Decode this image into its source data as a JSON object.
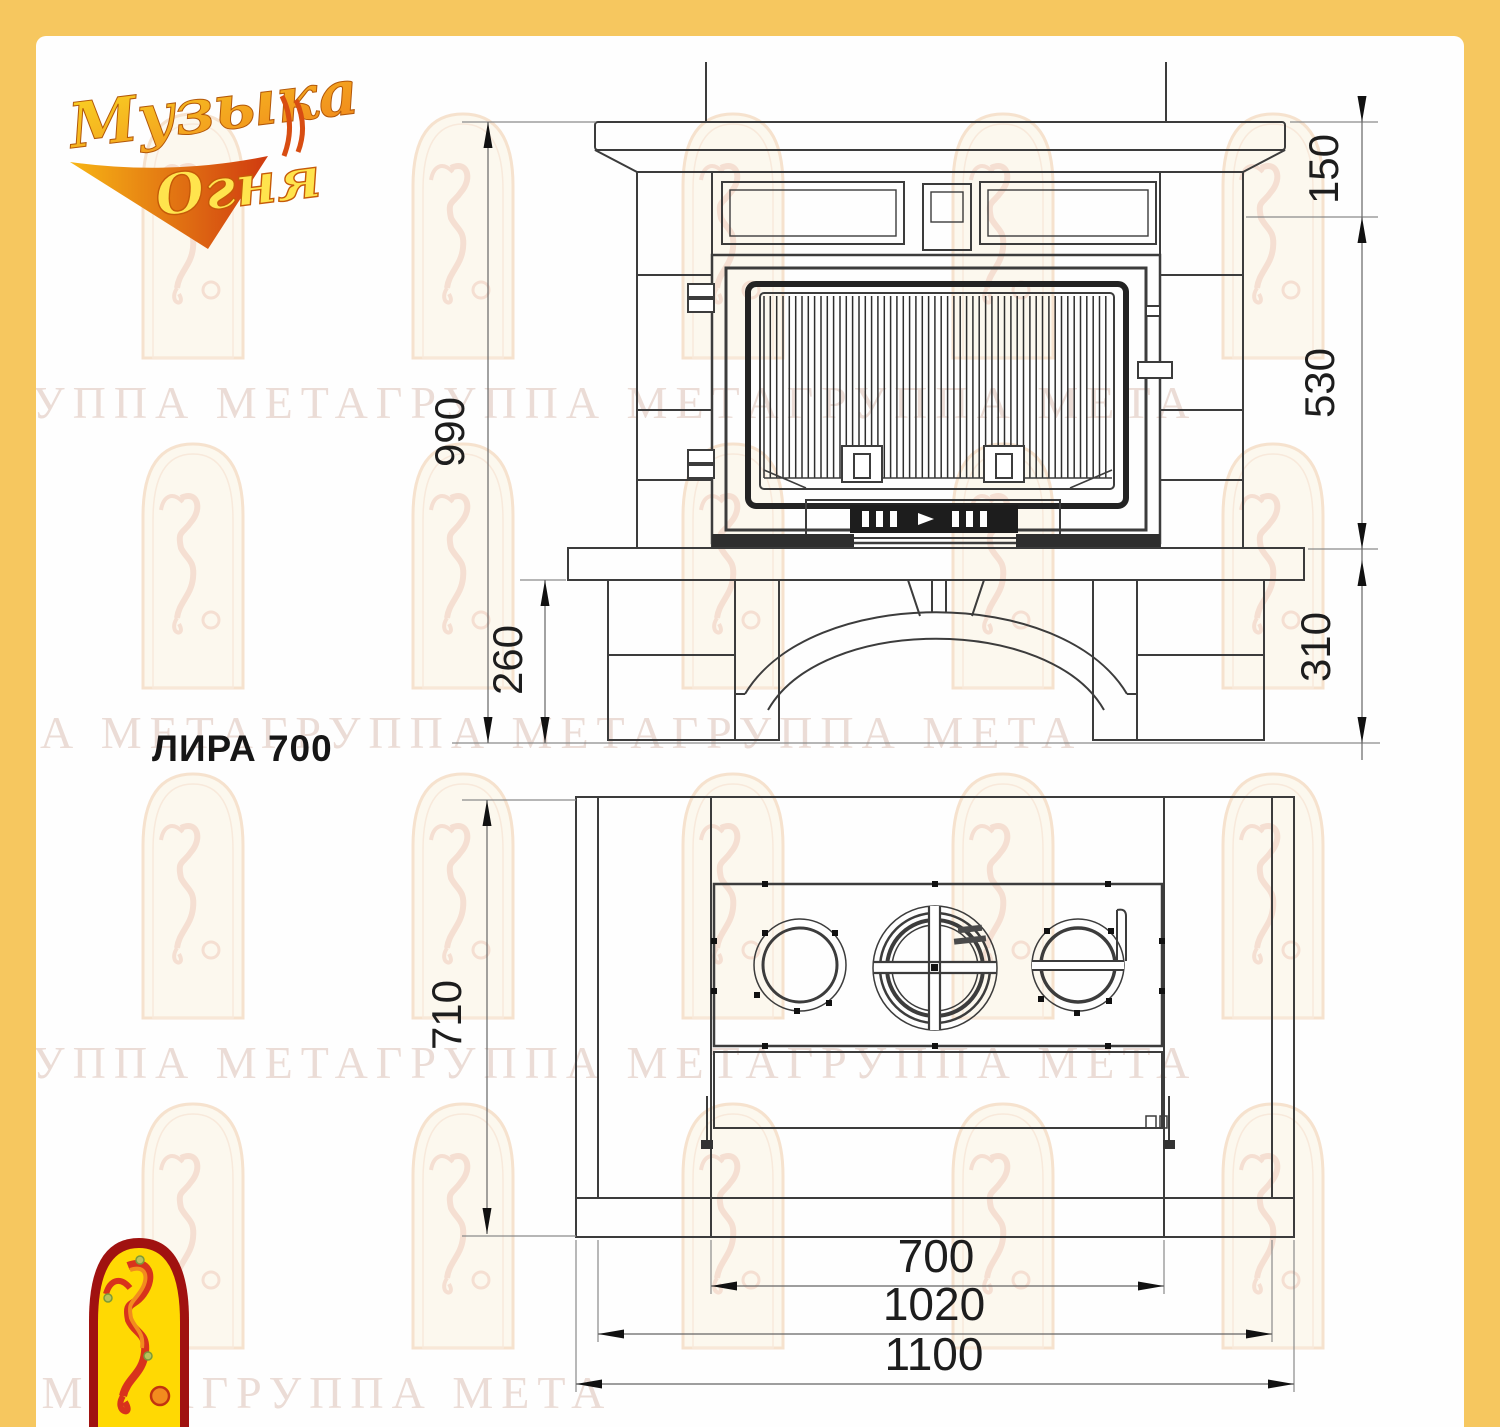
{
  "page": {
    "frame_color": "#F6C75F",
    "background": "#FFFFFF"
  },
  "brand": {
    "logo_line1": "Музыка",
    "logo_line2": "Огня"
  },
  "title": {
    "model_name": "ЛИРА 700"
  },
  "watermark": {
    "text": "ГРУППА МЕТАГРУППА МЕТАГРУППА МЕТА"
  },
  "drawing": {
    "front_view": {
      "name": "front-elevation",
      "dimensions_mm": {
        "total_height": "990",
        "mantel_height": "150",
        "firebox_opening_height": "530",
        "base_height": "310",
        "plinth_height": "260"
      }
    },
    "plan_view": {
      "name": "top-plan",
      "dimensions_mm": {
        "depth": "710",
        "firebox_width": "700",
        "inner_width": "1020",
        "overall_width": "1100"
      }
    }
  },
  "colors": {
    "line": "#3C3C3C",
    "dimension_line": "#8A8A8A",
    "logo_red": "#A01210",
    "logo_yellow": "#FFD903",
    "logo_orange": "#F0841C",
    "watermark_tint": "#E9D9D2"
  }
}
